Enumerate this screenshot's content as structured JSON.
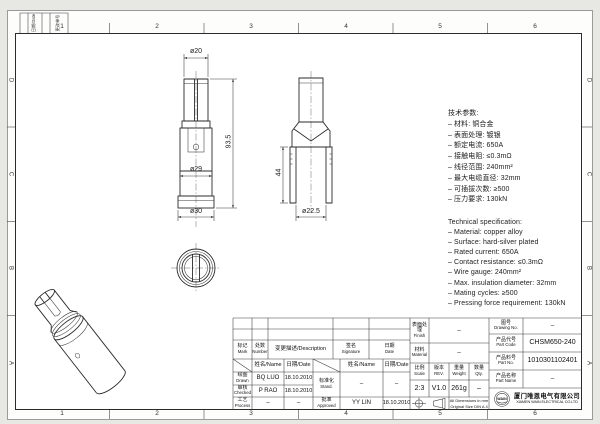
{
  "frame": {
    "zones_h": [
      "1",
      "2",
      "3",
      "4",
      "5",
      "6"
    ],
    "zones_v": [
      "D",
      "C",
      "B",
      "A"
    ],
    "corner1": "日期/Date",
    "corner2": "更改单号"
  },
  "dims": {
    "pin": "ø20",
    "height": "93.5",
    "body": "ø29",
    "base": "ø30",
    "depth": "44",
    "bore": "ø22.5"
  },
  "specs_cn": {
    "title": "技术参数:",
    "items": [
      "– 材料: 铜合金",
      "– 表面处理: 镀银",
      "– 额定电流: 650A",
      "– 接触电阻: ≤0.3mΩ",
      "– 线径范围: 240mm²",
      "– 最大电缆直径: 32mm",
      "– 可插拔次数: ≥500",
      "– 压力要求: 130kN"
    ]
  },
  "specs_en": {
    "title": "Technical specification:",
    "items": [
      "– Material: copper alloy",
      "– Surface: hard-silver plated",
      "– Rated current: 650A",
      "– Contact resistance: ≤0.3mΩ",
      "– Wire gauge: 240mm²",
      "– Max. insulation diameter: 32mm",
      "– Mating cycles: ≥500",
      "– Pressing force requirement: 130kN"
    ]
  },
  "tb": {
    "mark_cn": "标记",
    "mark_en": "Mark",
    "num_cn": "处数",
    "num_en": "Number",
    "desc": "变更描述/Description",
    "sig_cn": "签名",
    "sig_en": "Signature",
    "date_cn": "日期",
    "date_en": "Date",
    "name_hdr": "姓名/Name",
    "date_hdr": "日期/Date",
    "drawn_cn": "绘图",
    "drawn_en": "Drawn",
    "drawn_name": "BQ LUO",
    "drawn_date": "18.10.2010",
    "checked_cn": "审核",
    "checked_en": "Checked",
    "checked_name": "P RAO",
    "checked_date": "18.10.2010",
    "process_cn": "工艺",
    "process_en": "Process",
    "process_name": "–",
    "process_date": "–",
    "stand_cn": "标准化",
    "stand_en": "Stand.",
    "stand_name": "–",
    "stand_date": "–",
    "appr_cn": "批准",
    "appr_en": "Approved",
    "appr_name": "YY LIN",
    "appr_date": "18.10.2010",
    "finish_cn": "表面处理",
    "finish_en": "Finish",
    "finish_val": "–",
    "mat_cn": "材料",
    "mat_en": "Material",
    "mat_val": "–",
    "scale_cn": "比例",
    "scale_en": "Scale",
    "scale_val": "2:3",
    "rev_cn": "版本",
    "rev_en": "REV.",
    "rev_val": "V1.0",
    "wt_cn": "重量",
    "wt_en": "Weight",
    "wt_val": "261g",
    "qty_cn": "数量",
    "qty_en": "Qty.",
    "qty_val": "–",
    "note1": "All Dimensions in mm",
    "note2": "Original Size DIN A 4",
    "dwg_cn": "图号",
    "dwg_en": "Drawing No.",
    "dwg_val": "–",
    "code_cn": "产品代号",
    "code_en": "Part Code",
    "code_val": "CHSM650-240",
    "pn_cn": "产品料号",
    "pn_en": "Part No.",
    "pn_val": "1010301102401",
    "pname_cn": "产品名称",
    "pname_en": "Part Name",
    "pname_val": "–",
    "logo": "WAIN",
    "company_cn": "厦门唯恩电气有限公司",
    "company_en": "XIAMEN WAIN ELECTRICAL CO.LTD"
  }
}
